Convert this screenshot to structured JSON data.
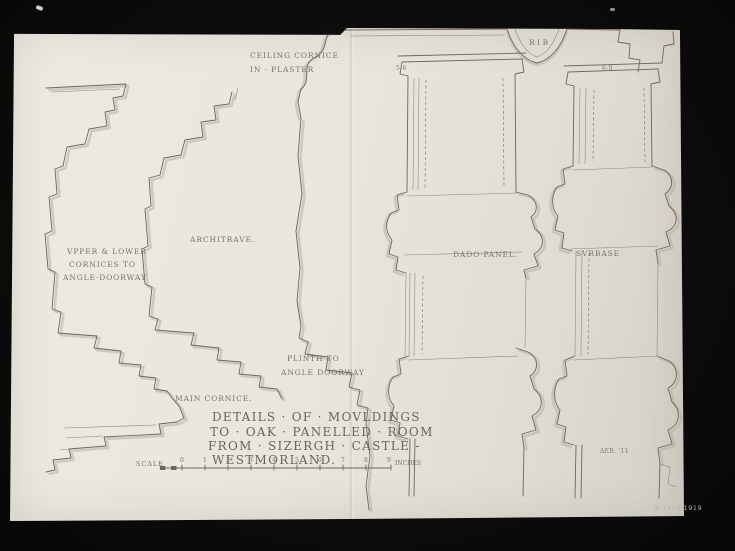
{
  "photo": {
    "background_color": "#0c0c0b",
    "paper_color": "#e8e5de",
    "ink_color": "#6e665a",
    "accession_number": "E.1316-1919"
  },
  "drawing": {
    "labels": {
      "ceiling_cornice_1": "CEILING CORNICE",
      "ceiling_cornice_2": "IN · PLASTER",
      "rib": "RIB",
      "dim_left": "5-6",
      "dim_right": "6-9",
      "doorway_cornices_1": "VPPER & LOWER",
      "doorway_cornices_2": "CORNICES TO",
      "doorway_cornices_3": "ANGLE·DOORWAY",
      "architrave": "ARCHITRAVE.",
      "dado_panel": "DADO·PANEL.",
      "surbase": "SVRBASE",
      "plinth_1": "PLINTH TO",
      "plinth_2": "ANGLE DOORWAY",
      "main_cornice": "MAIN CORNICE."
    },
    "title": {
      "line1": "DETAILS · OF · MOVLDINGS",
      "line2": "TO · OAK · PANELLED · ROOM",
      "line3": "FROM · SIZERGH · CASTLE -",
      "line4": "WESTMORLAND."
    },
    "scale_bar": {
      "label": "SCALE",
      "numbers": [
        "0",
        "1",
        "2",
        "3",
        "4",
        "5",
        "6",
        "7",
        "8",
        "9"
      ],
      "unit": "INCHES"
    },
    "signature": "AEB. '11"
  }
}
